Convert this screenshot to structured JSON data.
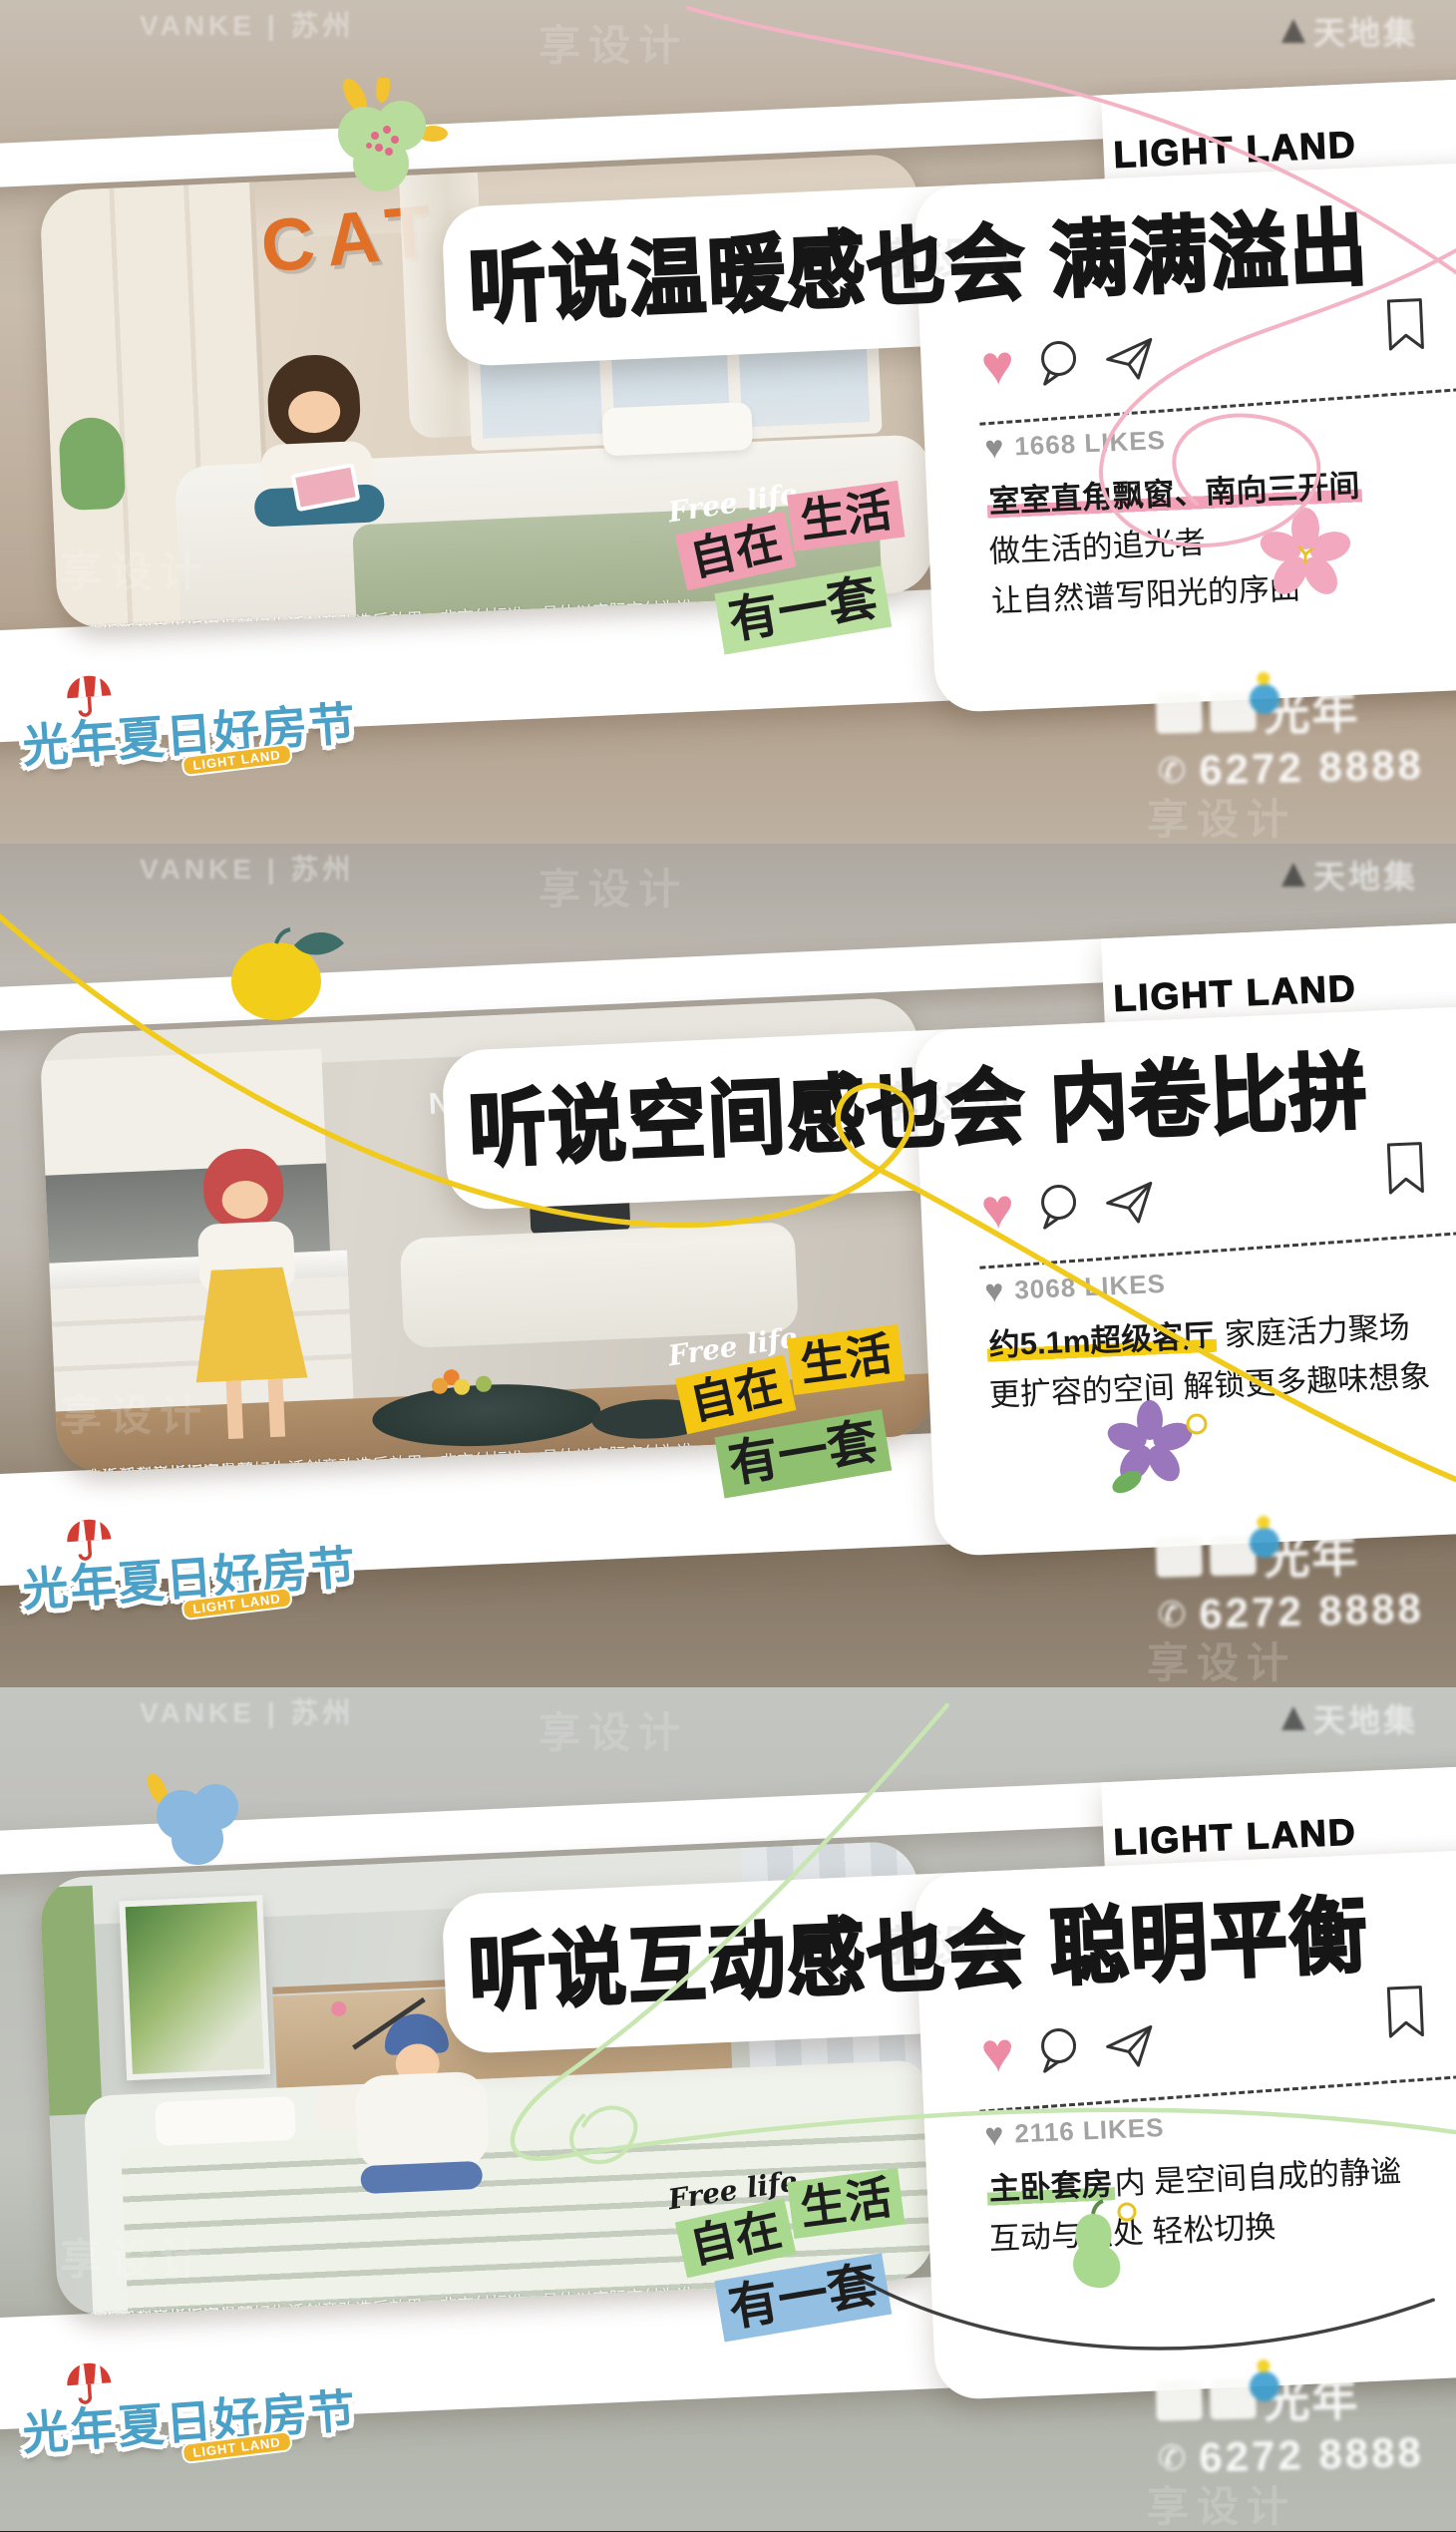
{
  "global": {
    "brand_watermark": "VANKE | 苏州",
    "site_watermark": "享设计",
    "corner_watermark": "天地集",
    "event_badge": "光年夏日好房节",
    "event_badge_tag": "LIGHT LAND",
    "dev_logo_text": "光年",
    "phone_icon": "✆",
    "phone": "6272 8888",
    "heart_glyph": "♥",
    "disclaimer_line1": "生活创意样板间实景图",
    "disclaimer_line2": "该生活创意样板间为美好生活创意改造后效果，非交付标准，具体以实际交付为准"
  },
  "banners": [
    {
      "logo": "LIGHT LAND",
      "headline": "听说温暖感也会 满满溢出",
      "likes": "1668 LIKES",
      "desc": {
        "highlight": "室室直角飘窗、南向三开间",
        "rest": "",
        "line2": "做生活的追光者",
        "line3": "让自然谱写阳光的序曲"
      },
      "sticker": {
        "script": "Free life",
        "tag1": "自在",
        "tag2": "生活",
        "tag3": "有一套"
      },
      "photo_text": "CAT",
      "colors": {
        "hl": "#f2a2b8",
        "tag12": "#f1a0b4",
        "tag3": "#b9e09e",
        "sq": "#f3b3c5",
        "script": "#ffffff"
      }
    },
    {
      "logo": "LIGHT LAND",
      "headline": "听说空间感也会 内卷比拼",
      "likes": "3068 LIKES",
      "desc": {
        "highlight": "约5.1m超级客厅",
        "rest": " 家庭活力聚场",
        "line2": "更扩容的空间 解锁更多趣味想象",
        "line3": ""
      },
      "sticker": {
        "script": "Free life",
        "tag1": "自在",
        "tag2": "生活",
        "tag3": "有一套"
      },
      "photo_text": "NOT TO FEEL",
      "colors": {
        "hl": "#f5cd12",
        "tag12": "#f5c713",
        "tag3": "#8fc06f",
        "sq": "#f0cb1e",
        "script": "#ffffff"
      }
    },
    {
      "logo": "LIGHT LAND",
      "headline": "听说互动感也会 聪明平衡",
      "likes": "2116 LIKES",
      "desc": {
        "highlight": "主卧套房",
        "rest": "内 是空间自成的静谧",
        "line2": "互动与独处 轻松切换",
        "line3": ""
      },
      "sticker": {
        "script": "Free life",
        "tag1": "自在",
        "tag2": "生活",
        "tag3": "有一套"
      },
      "photo_text": "",
      "colors": {
        "hl": "#acd992",
        "tag12": "#a9d88f",
        "tag3": "#93c0e2",
        "sq": "#c7e6b2",
        "script": "#1c1c1c"
      }
    }
  ]
}
